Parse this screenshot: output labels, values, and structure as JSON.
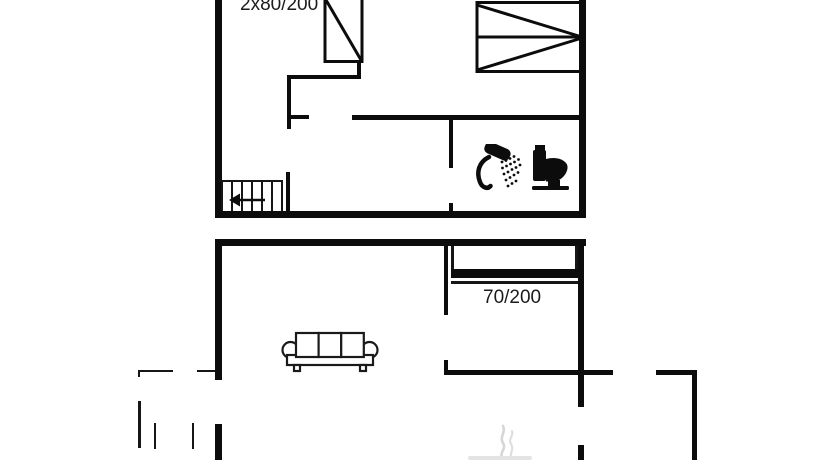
{
  "plan": {
    "labels": {
      "upper_bed_size": "2x80/200",
      "lower_bed_size": "70/200"
    },
    "colors": {
      "background": "#ffffff",
      "line": "#0c0c0c",
      "smoke": "#d6d6d6"
    },
    "icons": {
      "upper_left_bed": "single-bed-icon",
      "upper_right_bed": "double-bed-icon",
      "stairs": "stairs-icon",
      "stairs_arrow": "left-arrow-icon",
      "shower": "shower-icon",
      "toilet": "toilet-icon",
      "sofa": "sofa-icon",
      "lower_bed": "bed-icon",
      "stove_smoke": "smoke-icon"
    }
  }
}
